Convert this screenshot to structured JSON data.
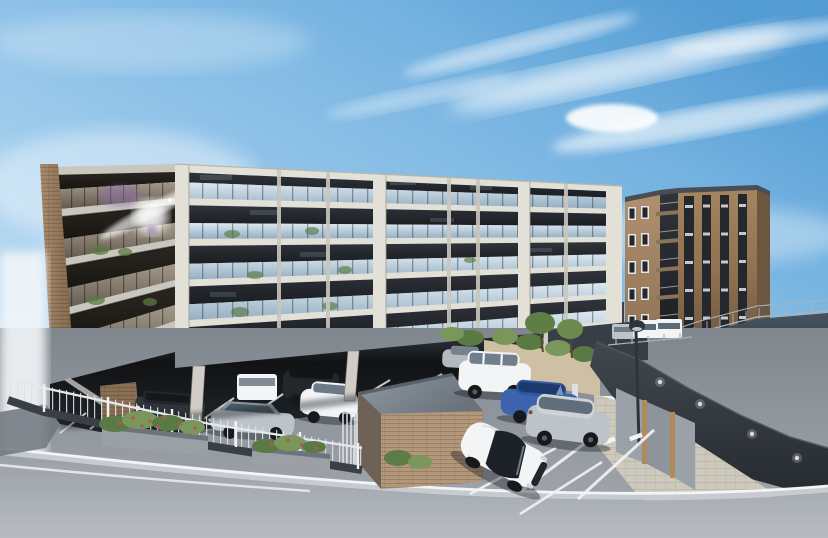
{
  "scene": {
    "title": "Exterior rendering of a mid-rise condominium with pilotis parking",
    "type": "3d-architectural-visualization",
    "sky": {
      "description": "blue sky, brightest deep blue at upper right, pale toward horizon, wispy cirrus cloud streaks and one small puff cloud",
      "cloud_count_visible": 7
    },
    "main_building": {
      "description": "long 5-story concrete-grid condominium with glass balcony balustrades, dark recessed interiors, brick end pier on the left, open pilotis parking underneath",
      "floors_front_face": 5,
      "floors_left_wing": 4,
      "balcony_bays_front": 8,
      "ground_level": "open pilotis parking with light columns and white stall striping",
      "details": [
        "sun glare and purple lens flare on upper left glazing",
        "potted plants on several balconies"
      ]
    },
    "annex_building": {
      "description": "narrow 5-story brown brick building at right with four dark vertical window strips on the front face, white-framed windows and stacked balconies on the left face, dark parapet",
      "floors": 5,
      "front_window_strips": 4,
      "side_window_rows": 5
    },
    "site": {
      "front_parking_cars_visible": 10,
      "terrace_vans_visible": 3,
      "features": [
        "metal picket fence with planters of green shrubs and red flowers along the street",
        "brick storage shed with flat gray roof in foreground",
        "tan garden wall with shrubs and two small trees",
        "white intercom pillar and entrance gate posts",
        "street lamp post",
        "curved charcoal retaining wall with four round lights",
        "white curved wall with roof-deck mesh railing above",
        "gray screen fence panels with wood posts",
        "paver sidewalk strip",
        "asphalt road with white curb lines crossing the foreground",
        "white dashed lane markings on the entrance driveway"
      ]
    },
    "cars": [
      {
        "color_name": "dark-gray",
        "hex": "#30343a",
        "type": "wagon",
        "location": "under building, far left"
      },
      {
        "color_name": "white",
        "hex": "#f2f4f6",
        "type": "minivan",
        "location": "under building, behind sedan"
      },
      {
        "color_name": "silver",
        "hex": "#bcc3c9",
        "type": "sedan",
        "location": "under building, front row"
      },
      {
        "color_name": "dark-gray",
        "hex": "#23262b",
        "type": "suv",
        "location": "under building, right"
      },
      {
        "color_name": "white",
        "hex": "#f2f4f6",
        "type": "compact",
        "location": "under building, right"
      },
      {
        "color_name": "silver",
        "hex": "#bcc3c9",
        "type": "compact",
        "location": "center lot, rear row"
      },
      {
        "color_name": "white",
        "hex": "#f2f4f6",
        "type": "suv",
        "location": "center lot"
      },
      {
        "color_name": "blue",
        "hex": "#3d63ae",
        "type": "sedan",
        "location": "front lot"
      },
      {
        "color_name": "silver",
        "hex": "#bcc3c9",
        "type": "hatchback",
        "location": "front lot"
      },
      {
        "color_name": "white",
        "hex": "#f2f4f6",
        "type": "coupe",
        "location": "foreground stall"
      },
      {
        "color_name": "silver",
        "hex": "#bcc3c9",
        "type": "van",
        "location": "annex terrace"
      },
      {
        "color_name": "white",
        "hex": "#f2f4f6",
        "type": "van",
        "location": "annex terrace"
      },
      {
        "color_name": "white",
        "hex": "#f2f4f6",
        "type": "van",
        "location": "annex terrace"
      }
    ],
    "colors": {
      "sky_top": "#549cd4",
      "sky_mid": "#9ecbec",
      "sky_low": "#eaf3fa",
      "cloud": "#ffffff",
      "haze": "#f2f6f9",
      "concrete_light": "#e3e0d8",
      "concrete_mid": "#c9c6bd",
      "concrete_dark": "#a9a69d",
      "facade_recess": "#23262c",
      "glass_light": "#dde9f1",
      "glass_mid": "#93adc0",
      "wing_glass_hi": "#a3998a",
      "wing_glass_lo": "#5f574a",
      "wing_recess": "#262219",
      "brick_light": "#a88a6c",
      "brick_dark": "#7d6349",
      "annex_face": "#8f7050",
      "annex_face_dark": "#6d5640",
      "annex_side": "#b09070",
      "annex_window": "#24272c",
      "annex_frame": "#e4e6e8",
      "annex_parapet": "#4a4e54",
      "pilotis_dark": "#101214",
      "pilotis_mid": "#3a4046",
      "lot_dark": "#7f868d",
      "lot_light": "#a6abb1",
      "road_dark": "#9aa0a6",
      "road_light": "#b7bcc1",
      "curb_gray": "#c6cbd0",
      "line_white": "#f2f4f6",
      "wall_charcoal": "#41484f",
      "wall_charcoal_dark": "#262b30",
      "wall_light_fixture": "#d8dce0",
      "white_wall": "#f4f7f8",
      "deck_slate": "#3f4b57",
      "railing_metal": "#aab3bb",
      "paver": "#cdc9bc",
      "panel_gray": "#9aa1a8",
      "post_wood": "#b08a5c",
      "fence_metal": "#e4e8ec",
      "fence_base_dark": "#3a3f45",
      "planter_box": "#9aa0a5",
      "foliage": "#5a7a44",
      "foliage_light": "#79975a",
      "flower_red": "#b5565c",
      "tan_wall": "#cfc0a3",
      "shed_brick": "#b3977a",
      "shed_roof": "#848d96",
      "lamp_dark": "#2f343a",
      "car_white": "#f2f4f6",
      "car_silver": "#bcc3c9",
      "car_blue": "#3d63ae",
      "car_dark": "#2b2f35",
      "tire": "#17191d",
      "shadow": "#1a1e22",
      "flare_purple": "#8d6bb0",
      "sun_glare": "#ffffff"
    }
  }
}
